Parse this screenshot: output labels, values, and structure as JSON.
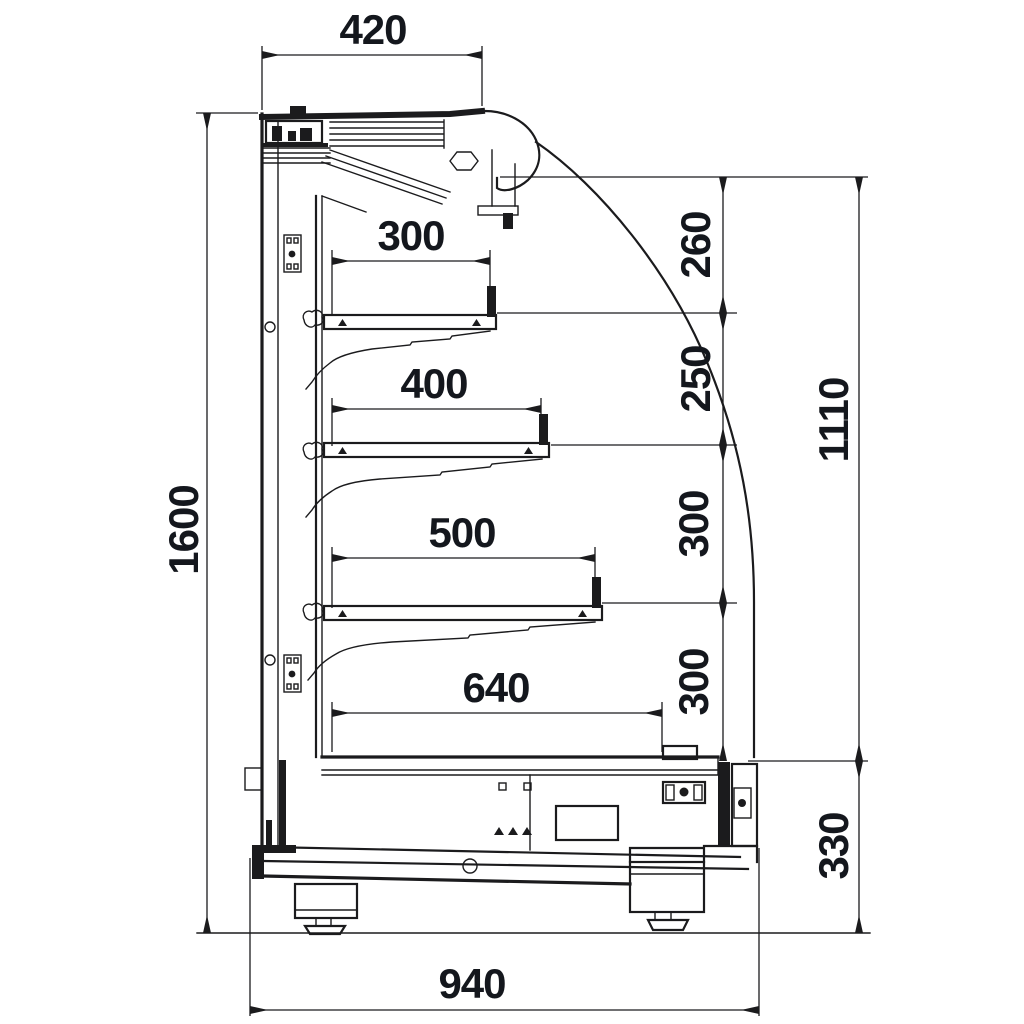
{
  "diagram": {
    "type": "technical-side-section-drawing",
    "subject": "refrigerated-multideck-display-case",
    "background_color": "#ffffff",
    "line_color": "#1b1b1d",
    "dimension_text_color": "#14171d",
    "dimensions": {
      "top_width": "420",
      "overall_height": "1600",
      "shelf1_width": "300",
      "shelf2_width": "400",
      "shelf3_width": "500",
      "base_shelf_width": "640",
      "canopy_to_shelf1": "260",
      "shelf1_to_shelf2": "250",
      "shelf2_to_shelf3": "300",
      "shelf3_to_base": "300",
      "opening_height": "1110",
      "base_height": "330",
      "overall_depth": "940"
    }
  }
}
